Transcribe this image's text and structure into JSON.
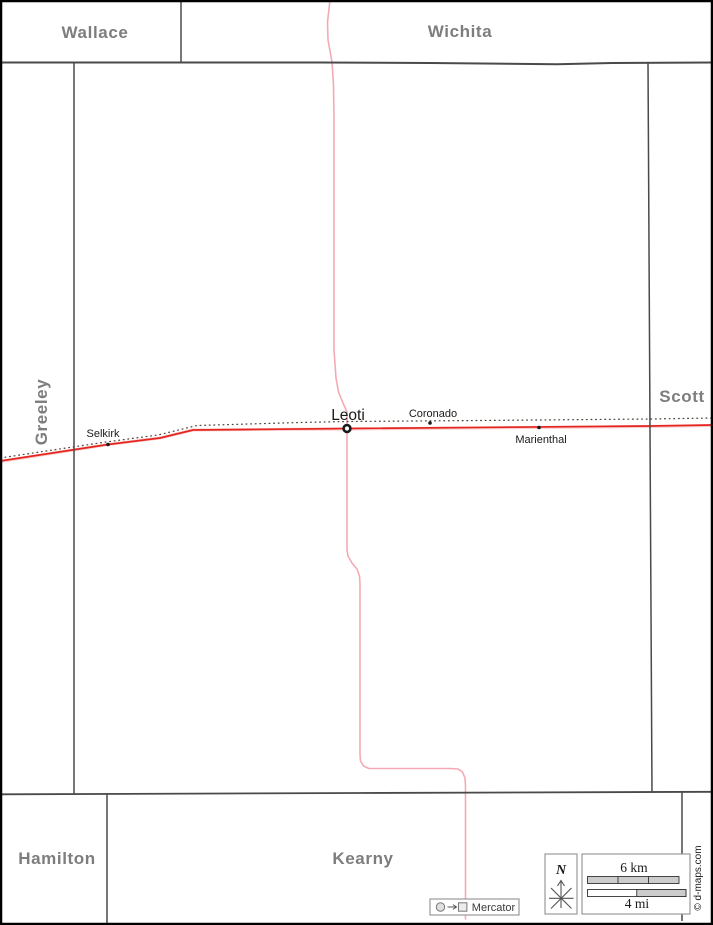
{
  "colors": {
    "frame_border": "#000000",
    "county_line": "#4a4a4a",
    "county_label": "#7d7d7d",
    "town_label": "#1a1a1a",
    "road_primary": "#e5261f",
    "road_primary_halo": "#f7c6c8",
    "road_secondary": "#f3aab6",
    "railroad": "#4d4238",
    "scale_bar_fill": "#cccccc",
    "scale_bar_stroke": "#333333",
    "widget_box_border": "#999999",
    "widget_glyph": "#555555"
  },
  "counties": {
    "wallace": "Wallace",
    "wichita": "Wichita",
    "greeley": "Greeley",
    "scott": "Scott",
    "hamilton": "Hamilton",
    "kearny": "Kearny"
  },
  "towns": {
    "leoti": "Leoti",
    "selkirk": "Selkirk",
    "coronado": "Coronado",
    "marienthal": "Marienthal"
  },
  "legend": {
    "north_label": "N",
    "scale_km": "6 km",
    "scale_mi": "4 mi",
    "projection": "Mercator",
    "copyright": "© d-maps.com"
  }
}
